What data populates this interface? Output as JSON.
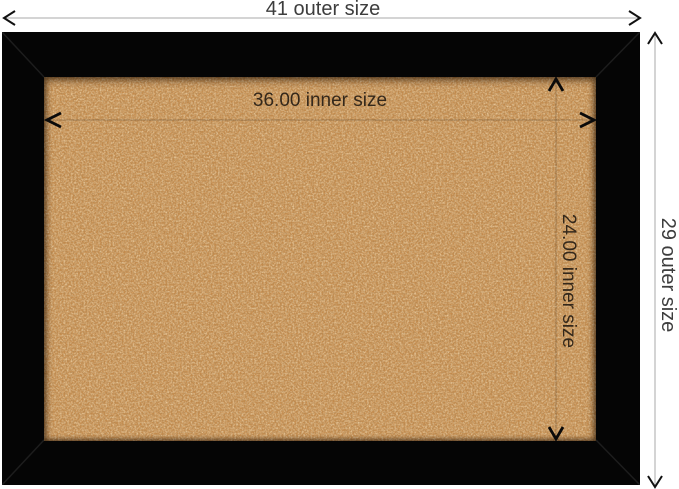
{
  "figure": {
    "type": "product-dimension-diagram",
    "subject": "framed cork board"
  },
  "annotations": {
    "outer_width": "41 outer size",
    "outer_height": "29 outer size",
    "inner_width": "36.00 inner size",
    "inner_height": "24.00 inner size"
  },
  "colors": {
    "background": "#ffffff",
    "frame": "#050505",
    "frame_miter_line": "#1d1d1d",
    "cork_base": "#c48a4b",
    "outer_dimension_line": "#aaaaaa",
    "inner_dimension_line": "rgba(0,0,0,0.22)",
    "arrow": "#111111",
    "outer_label_text": "#3d3d3d",
    "inner_label_text": "#34281b"
  },
  "icons": {
    "arrows": [
      "arrow-left-icon",
      "arrow-right-icon",
      "arrow-up-icon",
      "arrow-down-icon"
    ]
  }
}
